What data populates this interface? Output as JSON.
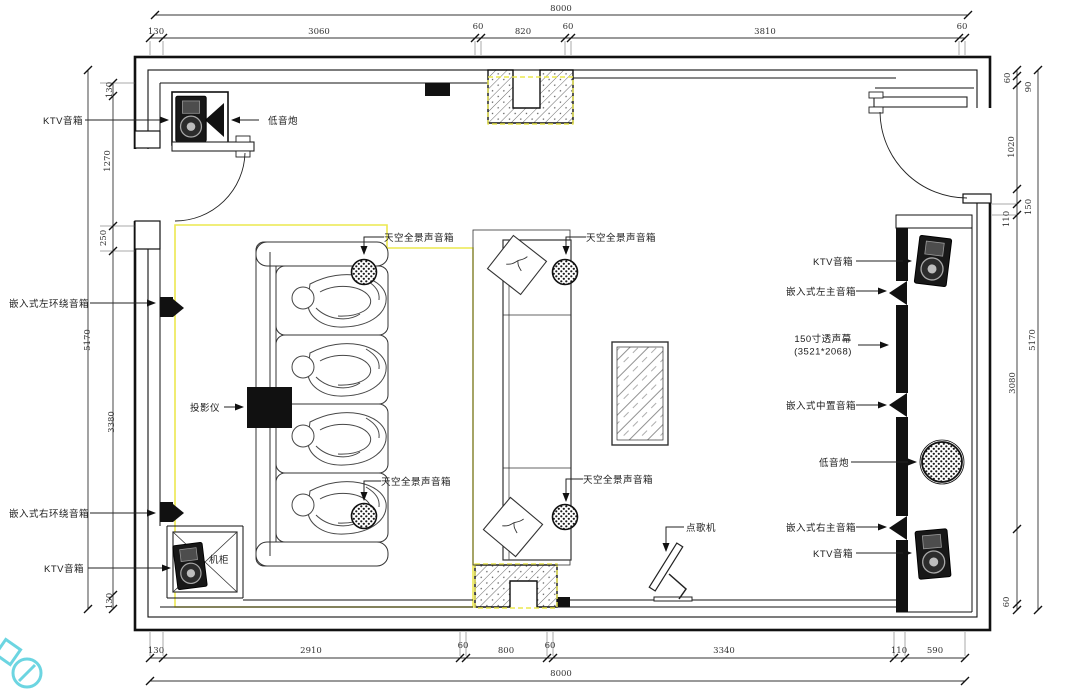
{
  "drawing": {
    "type": "home-theater-ktv-floor-plan",
    "colors": {
      "line": "#111111",
      "dim_line": "#333333",
      "highlight_yellow": "#ece84f",
      "watermark_teal": "#3cc7d8"
    }
  },
  "annotation_labels": [
    {
      "id": "ktv-speaker-label-top-left",
      "text": "KTV音箱",
      "x": 63,
      "y": 120
    },
    {
      "id": "subwoofer-label-top-left",
      "text": "低音炮",
      "x": 283,
      "y": 120
    },
    {
      "id": "embedded-left-surround-label",
      "text": "嵌入式左环绕音箱",
      "x": 49,
      "y": 303
    },
    {
      "id": "embedded-right-surround-label",
      "text": "嵌入式右环绕音箱",
      "x": 49,
      "y": 513
    },
    {
      "id": "ktv-speaker-label-bottom-left",
      "text": "KTV音箱",
      "x": 64,
      "y": 568
    },
    {
      "id": "projector-label",
      "text": "投影仪",
      "x": 205,
      "y": 407
    },
    {
      "id": "cabinet-label",
      "text": "机柜",
      "x": 219,
      "y": 559
    },
    {
      "id": "sky-speaker-label-top-left",
      "text": "天空全景声音箱",
      "x": 419,
      "y": 237
    },
    {
      "id": "sky-speaker-label-top-right",
      "text": "天空全景声音箱",
      "x": 621,
      "y": 237
    },
    {
      "id": "sky-speaker-label-bottom-left",
      "text": "天空全景声音箱",
      "x": 416,
      "y": 481
    },
    {
      "id": "sky-speaker-label-bottom-right",
      "text": "天空全景声音箱",
      "x": 618,
      "y": 479
    },
    {
      "id": "song-machine-label",
      "text": "点歌机",
      "x": 701,
      "y": 527
    },
    {
      "id": "ktv-speaker-label-top-right",
      "text": "KTV音箱",
      "x": 833,
      "y": 261
    },
    {
      "id": "embedded-left-main-label",
      "text": "嵌入式左主音箱",
      "x": 821,
      "y": 291
    },
    {
      "id": "screen-label-line1",
      "text": "150寸透声幕",
      "x": 823,
      "y": 338
    },
    {
      "id": "screen-label-line2",
      "text": "(3521*2068)",
      "x": 823,
      "y": 352
    },
    {
      "id": "embedded-center-label",
      "text": "嵌入式中置音箱",
      "x": 821,
      "y": 405
    },
    {
      "id": "subwoofer-label-right",
      "text": "低音炮",
      "x": 834,
      "y": 462
    },
    {
      "id": "embedded-right-main-label",
      "text": "嵌入式右主音箱",
      "x": 821,
      "y": 527
    },
    {
      "id": "ktv-speaker-label-bottom-right",
      "text": "KTV音箱",
      "x": 833,
      "y": 553
    }
  ],
  "dimension_labels": [
    {
      "id": "dim-top-total",
      "text": "8000",
      "x": 561,
      "y": 9
    },
    {
      "id": "dim-top-1",
      "text": "130",
      "x": 156,
      "y": 32
    },
    {
      "id": "dim-top-2",
      "text": "3060",
      "x": 319,
      "y": 32
    },
    {
      "id": "dim-top-3",
      "text": "60",
      "x": 478,
      "y": 27
    },
    {
      "id": "dim-top-4",
      "text": "820",
      "x": 523,
      "y": 32
    },
    {
      "id": "dim-top-5",
      "text": "60",
      "x": 568,
      "y": 27
    },
    {
      "id": "dim-top-6",
      "text": "3810",
      "x": 765,
      "y": 32
    },
    {
      "id": "dim-top-7",
      "text": "60",
      "x": 962,
      "y": 27
    },
    {
      "id": "dim-bottom-1",
      "text": "130",
      "x": 156,
      "y": 651
    },
    {
      "id": "dim-bottom-2",
      "text": "2910",
      "x": 311,
      "y": 651
    },
    {
      "id": "dim-bottom-3",
      "text": "60",
      "x": 463,
      "y": 646
    },
    {
      "id": "dim-bottom-4",
      "text": "800",
      "x": 506,
      "y": 651
    },
    {
      "id": "dim-bottom-5",
      "text": "60",
      "x": 550,
      "y": 646
    },
    {
      "id": "dim-bottom-6",
      "text": "3340",
      "x": 724,
      "y": 651
    },
    {
      "id": "dim-bottom-7",
      "text": "110",
      "x": 899,
      "y": 651
    },
    {
      "id": "dim-bottom-8",
      "text": "590",
      "x": 935,
      "y": 651
    },
    {
      "id": "dim-bottom-total",
      "text": "8000",
      "x": 561,
      "y": 674
    },
    {
      "id": "dim-left-1",
      "text": "130",
      "x": 110,
      "y": 90,
      "rot": true
    },
    {
      "id": "dim-left-2",
      "text": "1270",
      "x": 108,
      "y": 161,
      "rot": true
    },
    {
      "id": "dim-left-3",
      "text": "250",
      "x": 104,
      "y": 238,
      "rot": true
    },
    {
      "id": "dim-left-4",
      "text": "3380",
      "x": 112,
      "y": 422,
      "rot": true
    },
    {
      "id": "dim-left-5",
      "text": "130",
      "x": 110,
      "y": 601,
      "rot": true
    },
    {
      "id": "dim-left-total",
      "text": "5170",
      "x": 88,
      "y": 340,
      "rot": true
    },
    {
      "id": "dim-right-1",
      "text": "60",
      "x": 1008,
      "y": 78,
      "rot": true
    },
    {
      "id": "dim-right-2",
      "text": "90",
      "x": 1029,
      "y": 87,
      "rot": true
    },
    {
      "id": "dim-right-3",
      "text": "1020",
      "x": 1012,
      "y": 147,
      "rot": true
    },
    {
      "id": "dim-right-4",
      "text": "150",
      "x": 1029,
      "y": 207,
      "rot": true
    },
    {
      "id": "dim-right-5",
      "text": "110",
      "x": 1007,
      "y": 219,
      "rot": true
    },
    {
      "id": "dim-right-6",
      "text": "3080",
      "x": 1013,
      "y": 383,
      "rot": true
    },
    {
      "id": "dim-right-7",
      "text": "60",
      "x": 1007,
      "y": 602,
      "rot": true
    },
    {
      "id": "dim-right-total",
      "text": "5170",
      "x": 1033,
      "y": 340,
      "rot": true
    }
  ]
}
